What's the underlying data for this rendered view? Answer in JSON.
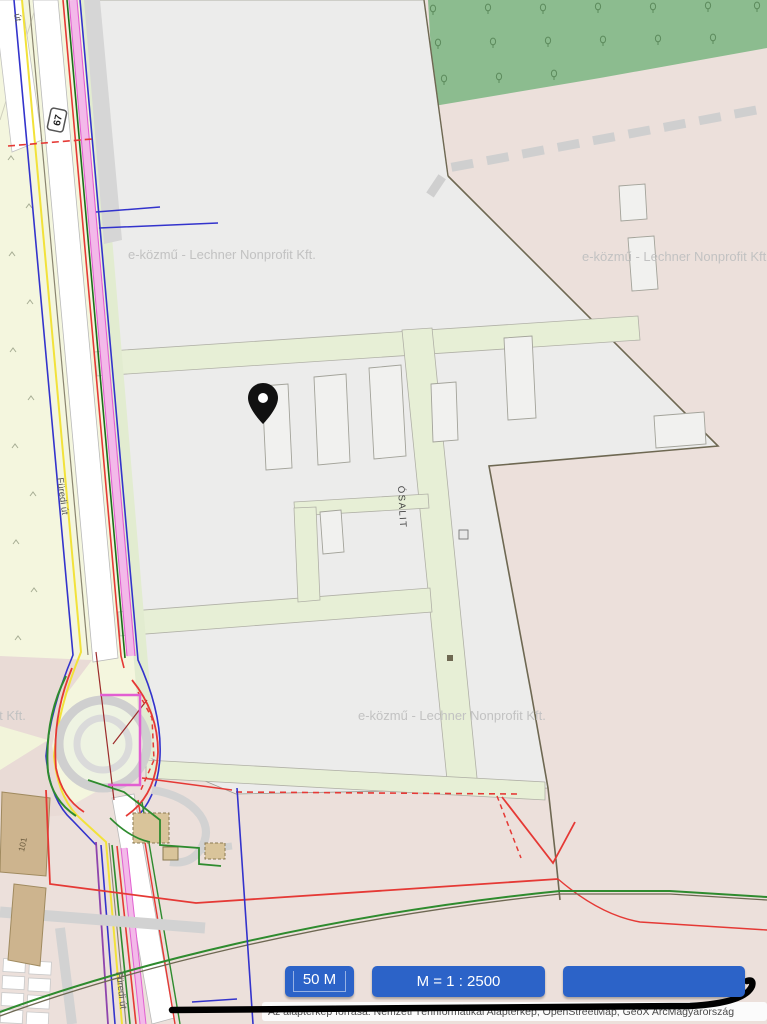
{
  "buttons": {
    "scale": "50 M",
    "ratio": "M = 1 : 2500",
    "extra": ""
  },
  "attribution": "Az alaptérkép forrása: Nemzeti Térinformatikai Alaptérkép, OpenStreetMap, GeoX ArcMagyarország",
  "watermark": "e-közmű - Lechner Nonprofit Kft.",
  "labels": {
    "shield": "67",
    "furedi": "Füredi út",
    "osalit": "ÓSALIT",
    "ut": "út.",
    "b101": "101"
  },
  "colors": {
    "button_blue": "#2c63c8",
    "pin_black": "#111111",
    "base_pink": "#ece0db",
    "field_yellow": "#f4f6de",
    "road_green": "#e7efd6",
    "parcel_gray": "#ececeb",
    "forest_green": "#8cbc8f",
    "utility_red": "#e53935",
    "utility_green": "#2e8b2e",
    "utility_blue": "#3333cc",
    "utility_magenta": "#e25fd2",
    "utility_yellow": "#f2e23a"
  }
}
